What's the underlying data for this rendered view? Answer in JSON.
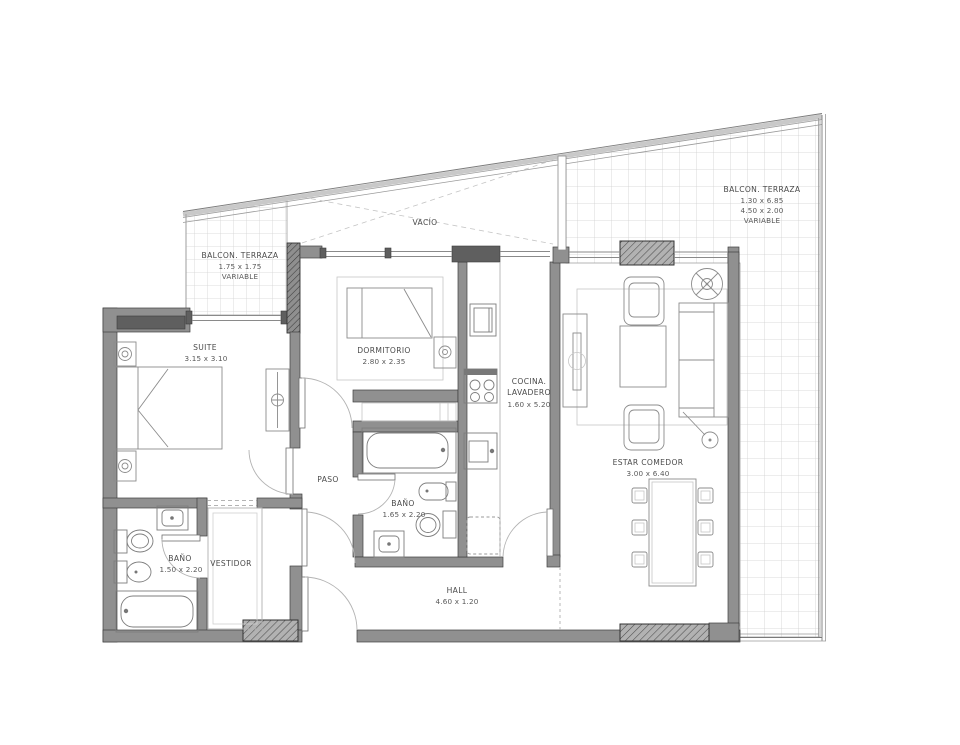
{
  "colors": {
    "wall": "#909090",
    "wall_dark": "#5f5f5f",
    "text": "#4a4a4a",
    "tile_line": "#cfcfcf"
  },
  "rooms": {
    "suite": {
      "label": "SUITE",
      "dims": "3.15 x 3.10"
    },
    "dormitorio": {
      "label": "DORMITORIO",
      "dims": "2.80 x 2.35"
    },
    "cocina_lavadero": {
      "label_line1": "COCINA.",
      "label_line2": "LAVADERO",
      "dims": "1.60 x 5.20"
    },
    "estar_comedor": {
      "label": "ESTAR COMEDOR",
      "dims": "3.00 x 6.40"
    },
    "bano_principal": {
      "label": "BAÑO",
      "dims": "1.65 x 2.20"
    },
    "bano_suite": {
      "label": "BAÑO",
      "dims": "1.50 x 2.20"
    },
    "vestidor": {
      "label": "VESTIDOR"
    },
    "paso": {
      "label": "PASO"
    },
    "hall": {
      "label": "HALL",
      "dims": "4.60 x 1.20"
    },
    "vacio": {
      "label": "VACÍO"
    },
    "balcon_izquierdo": {
      "label": "BALCON. TERRAZA",
      "dims": "1.75 x 1.75",
      "note": "VARIABLE"
    },
    "balcon_derecho": {
      "label": "BALCON. TERRAZA",
      "dims_a": "1.30 x 6.85",
      "dims_b": "4.50 x 2.00",
      "note": "VARIABLE"
    }
  }
}
